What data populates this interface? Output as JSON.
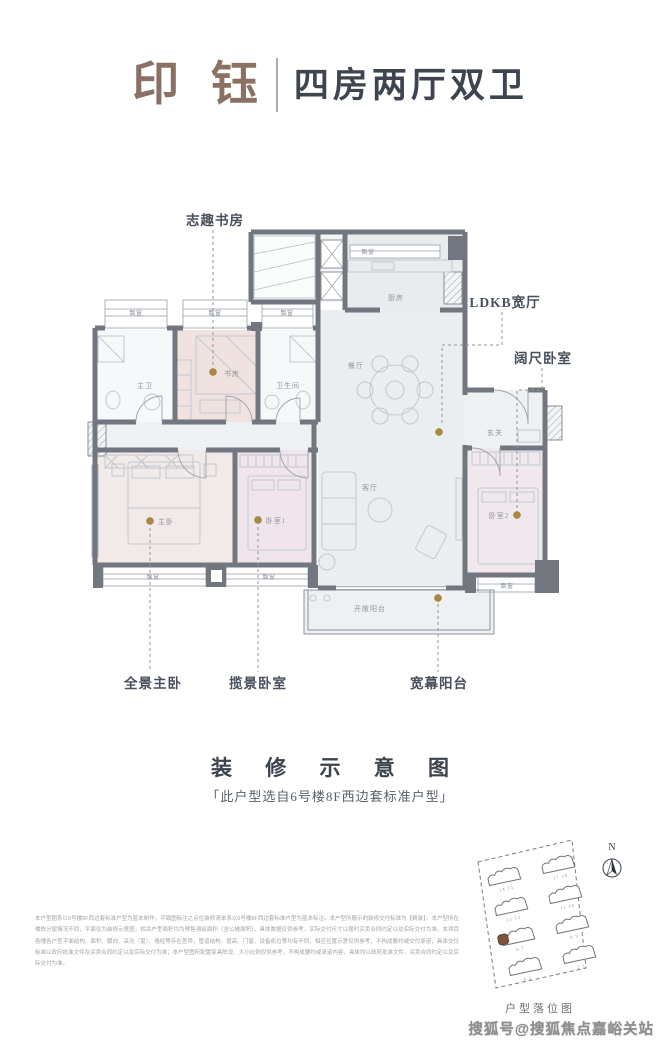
{
  "header": {
    "brand": "印 钰",
    "layout_name": "四房两厅双卫"
  },
  "floorplan": {
    "callouts": {
      "study_corner": "志趣书房",
      "ldkb": "LDKB宽厅",
      "wide_bedroom": "阔尺卧室",
      "panoramic_master": "全景主卧",
      "view_bedroom": "揽景卧室",
      "wide_balcony": "宽幕阳台"
    },
    "rooms": {
      "master_bath": "主卫",
      "study": "书房",
      "bathroom": "卫生间",
      "kitchen": "厨房",
      "dining": "餐厅",
      "living": "客厅",
      "foyer": "玄关",
      "master": "主卧",
      "bedroom1": "卧室1",
      "bedroom2": "卧室2",
      "balcony": "开敞阳台"
    },
    "bay_window": "飘窗"
  },
  "caption": {
    "title": "装 修 示 意 图",
    "note": "「此户型选自6号楼8F西边套标准户型」"
  },
  "disclaimer": "本户型图系以6号楼8F西边套标准户型为蓝本制作，平面图标注之点位装修清单系以6号楼8F西边套标准户型为蓝本标注。本户型所展示的装修交付标准为【精装】。本户型所在楼栋分层情况不同，平面仅为装修示意图，相关户型面积均为预售测绘面积（含公摊面积），具体数据仅供参考，实际交付尺寸以届时买卖合同约定以及实际交付为准。本项目各幢各户型平面结构、面积、朝向、采光（窗）、墙柱等存在差异，管道结构、层高、门窗、设备机位等均有不同，相应位置示意仅供参考，不构成要约或交付承诺，具体交付标准以政府批准文件及买卖合同约定以及实际交付为准；本户型图所配置家具陈设、大小比例仅供参考，不构成要约或承诺内容，具体均以政府批准文件、买卖合同约定以及实际交付为准。",
  "sitemap": {
    "label": "户型落位图",
    "north": "N",
    "buildings": [
      {
        "num": "14 15"
      },
      {
        "num": "17 18"
      },
      {
        "num": "13 12"
      },
      {
        "num": "11 10"
      },
      {
        "num": "6 7",
        "highlight": true
      },
      {
        "num": "8 9"
      },
      {
        "num": "4 3"
      },
      {
        "num": "2 1"
      }
    ]
  },
  "watermark": "搜狐号@搜狐焦点嘉峪关站",
  "colors": {
    "brand": "#8a7164",
    "wall": "#72777f",
    "gold_dot": "#a8893e",
    "study_fill": "#f0e3df",
    "bedroom_fill": "#f0e5eb",
    "ldk_fill": "#eaeef1"
  }
}
